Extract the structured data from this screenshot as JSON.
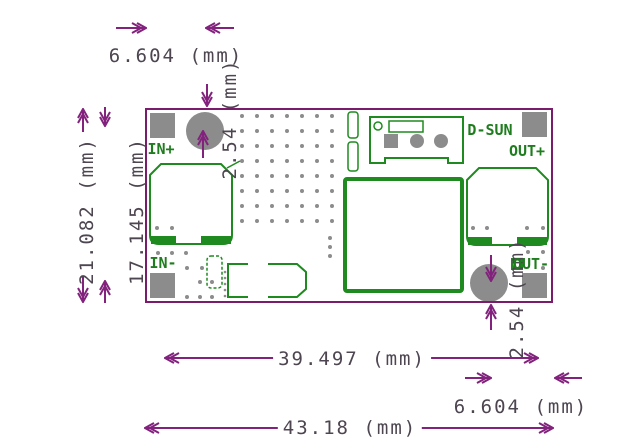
{
  "drawing": {
    "type": "pcb-dimension-drawing",
    "board_labels": {
      "in_plus": "IN+",
      "in_minus": "IN-",
      "out_plus": "OUT+",
      "out_minus": "OUT-",
      "brand": "D-SUN"
    },
    "dimensions": {
      "top_hole_x_offset": "6.604 (mm)",
      "top_hole_y_offset": "2.54 (mm)",
      "board_height": "21.082 (mm)",
      "pad_row_span": "17.145 (mm)",
      "hole_span_width": "39.497 (mm)",
      "board_width": "43.18 (mm)",
      "bottom_hole_x_offset": "6.604 (mm)",
      "bottom_hole_y_offset": "2.54 (mm)"
    },
    "colors": {
      "dimension_line": "#82227d",
      "dimension_text": "#4d4550",
      "board_outline": "#7a1b6b",
      "silkscreen": "#1f8a1f",
      "silk_text": "#1f7d1f",
      "pad": "#8c8c8c",
      "background": "#ffffff"
    },
    "via_grid": {
      "x0": 242,
      "y0": 116,
      "dx": 15,
      "dy": 15,
      "cols": 7,
      "rows": 8
    },
    "extra_vias": [
      [
        157,
        228
      ],
      [
        172,
        228
      ],
      [
        158,
        253
      ],
      [
        172,
        253
      ],
      [
        186,
        253
      ],
      [
        187,
        268
      ],
      [
        202,
        268
      ],
      [
        200,
        282
      ],
      [
        212,
        282
      ],
      [
        187,
        297
      ],
      [
        200,
        297
      ],
      [
        212,
        297
      ],
      [
        330,
        238
      ],
      [
        330,
        247
      ],
      [
        330,
        256
      ],
      [
        473,
        228
      ],
      [
        487,
        228
      ],
      [
        527,
        228
      ],
      [
        543,
        228
      ],
      [
        528,
        252
      ],
      [
        543,
        252
      ],
      [
        543,
        268
      ]
    ],
    "small_vias": [
      [
        225,
        272
      ],
      [
        225,
        278
      ],
      [
        225,
        284
      ],
      [
        225,
        290
      ],
      [
        225,
        296
      ]
    ]
  }
}
